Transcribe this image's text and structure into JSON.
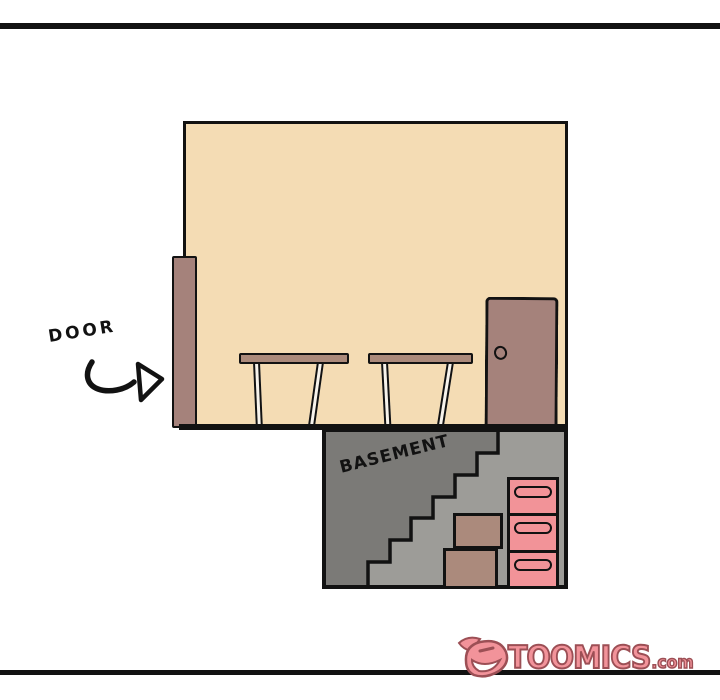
{
  "labels": {
    "door": "DOOR",
    "basement": "BASEMENT"
  },
  "watermark": {
    "brand": "TOOMICS",
    "suffix": ".com"
  },
  "icons": {
    "arrow": "curved-right-arrow",
    "logo": "devil-face"
  },
  "colors": {
    "ink": "#121212",
    "room_fill": "#f4dcb4",
    "wood_brown": "#a5827b",
    "table_brown": "#ab8a7b",
    "leg_fill": "#f7f3ec",
    "basement_dark": "#7b7a77",
    "basement_light": "#9d9c98",
    "box_brown": "#ab8a7c",
    "drawer_pink": "#f29398",
    "logo_pink": "#f2939a",
    "logo_outline": "#9c4f55"
  }
}
